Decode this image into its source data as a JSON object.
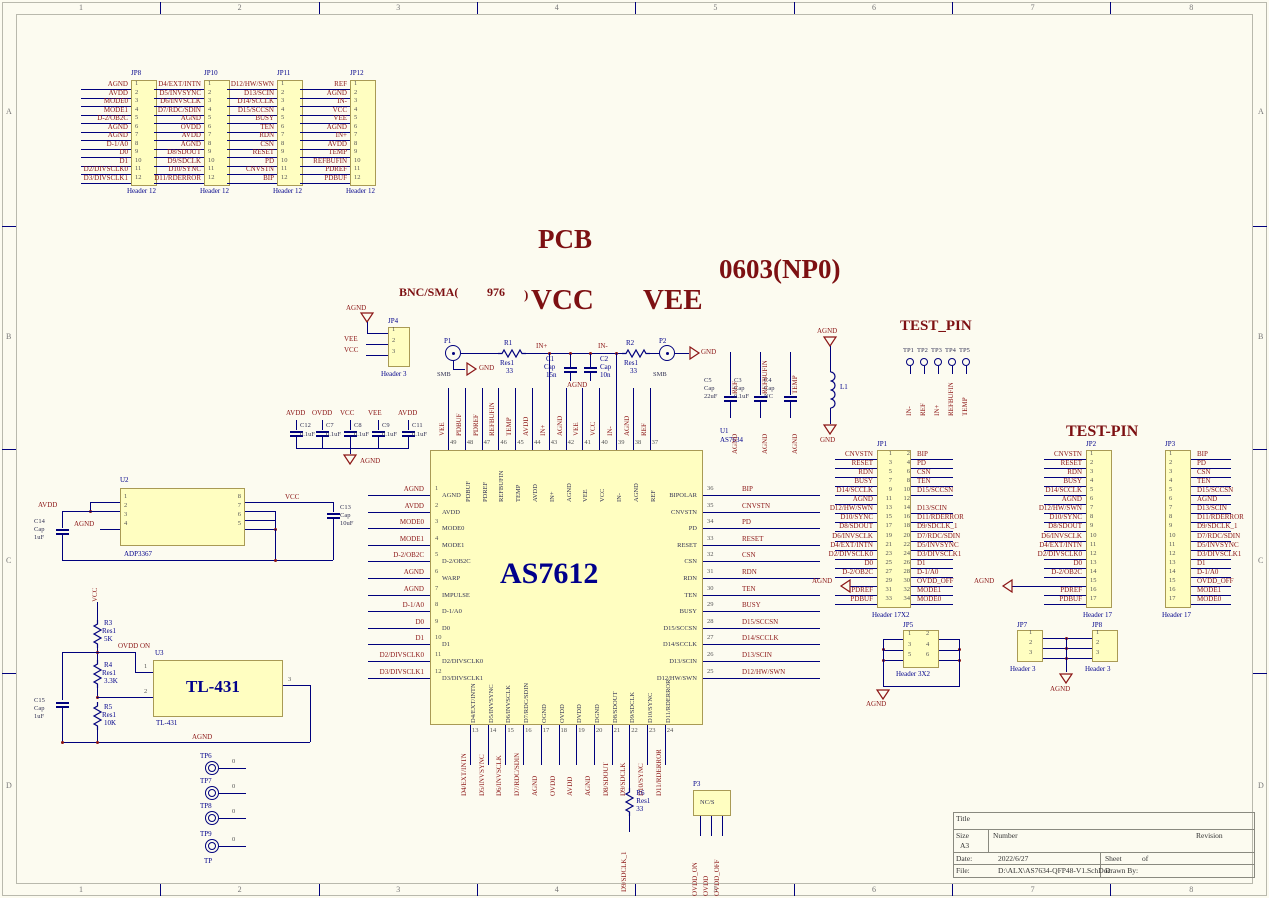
{
  "sheet": {
    "zones_h": [
      "1",
      "2",
      "3",
      "4",
      "5",
      "6",
      "7",
      "8"
    ],
    "zones_v": [
      "A",
      "B",
      "C",
      "D"
    ]
  },
  "colors": {
    "wire": "#00007d",
    "net_label": "#8b1515",
    "designator": "#00008b",
    "component_fill": "#fffec1",
    "title_red": "#7d1012"
  },
  "texts": {
    "pcb": "PCB",
    "bnc_sma": "BNC/SMA(",
    "bnc_num": "976",
    "paren": ")",
    "vcc": "VCC",
    "vee": "VEE",
    "cap_note": "0603(NP0)",
    "test_pin": "TEST_PIN",
    "test_pin2": "TEST-PIN"
  },
  "top_headers": [
    {
      "name": "JP8",
      "type": "Header 12",
      "labels": [
        "AGND",
        "AVDD",
        "MODE0",
        "MODE1",
        "D-2/OB2C",
        "AGND",
        "AGND",
        "D-1/A0",
        "D0",
        "D1",
        "D2/DIVSCLK0",
        "D3/DIVSCLK1"
      ]
    },
    {
      "name": "JP10",
      "type": "Header 12",
      "labels": [
        "D4/EXT/INTN",
        "D5/INVSYNC",
        "D6/INVSCLK",
        "D7/RDC/SDIN",
        "AGND",
        "OVDD",
        "AVDD",
        "AGND",
        "D8/SDOUT",
        "D9/SDCLK",
        "D10/SYNC",
        "D11/RDERROR"
      ]
    },
    {
      "name": "JP11",
      "type": "Header 12",
      "labels": [
        "D12/HW/SWN",
        "D13/SCIN",
        "D14/SCCLK",
        "D15/SCCSN",
        "BUSY",
        "TEN",
        "RDN",
        "CSN",
        "RESET",
        "PD",
        "CNVSTN",
        "BIP"
      ]
    },
    {
      "name": "JP12",
      "type": "Header 12",
      "labels": [
        "REF",
        "AGND",
        "IN-",
        "VCC",
        "VEE",
        "AGND",
        "IN+",
        "AVDD",
        "TEMP",
        "REFBUFIN",
        "PDREF",
        "PDBUF"
      ]
    }
  ],
  "jp4": {
    "name": "JP4",
    "type": "Header 3",
    "agnd": "AGND",
    "labels": [
      "VEE",
      "VCC"
    ]
  },
  "front_end": {
    "p1": "P1",
    "p2": "P2",
    "smb": "SMB",
    "gnd": "GND",
    "agnd": "AGND",
    "in_p": "IN+",
    "in_n": "IN-",
    "r1": {
      "d": "R1",
      "t": "Res1",
      "v": "33"
    },
    "r2": {
      "d": "R2",
      "t": "Res1",
      "v": "33"
    },
    "c1": {
      "d": "C1",
      "t": "Cap",
      "v": "15n"
    },
    "c2": {
      "d": "C2",
      "t": "Cap",
      "v": "10n"
    }
  },
  "decoupling": {
    "nets": [
      "AVDD",
      "OVDD",
      "VCC",
      "VEE",
      "AVDD"
    ],
    "designators": [
      "C12",
      "C7",
      "C8",
      "C9",
      "C11"
    ],
    "values": [
      "0.1uF",
      "0.1uF",
      "0.1uF",
      "0.1uF",
      "0.1uF"
    ],
    "agnd": "AGND"
  },
  "chip": {
    "designator": "U1",
    "type": "AS7634",
    "big_label": "AS7612",
    "left": [
      {
        "n": 1,
        "outer": "AGND",
        "inner": "AGND"
      },
      {
        "n": 2,
        "outer": "AVDD",
        "inner": "AVDD"
      },
      {
        "n": 3,
        "outer": "MODE0",
        "inner": "MODE0"
      },
      {
        "n": 4,
        "outer": "MODE1",
        "inner": "MODE1"
      },
      {
        "n": 5,
        "outer": "D-2/OB2C",
        "inner": "D-2/OB2C"
      },
      {
        "n": 6,
        "outer": "AGND",
        "inner": "WARP"
      },
      {
        "n": 7,
        "outer": "AGND",
        "inner": "IMPULSE"
      },
      {
        "n": 8,
        "outer": "D-1/A0",
        "inner": "D-1/A0"
      },
      {
        "n": 9,
        "outer": "D0",
        "inner": "D0"
      },
      {
        "n": 10,
        "outer": "D1",
        "inner": "D1"
      },
      {
        "n": 11,
        "outer": "D2/DIVSCLK0",
        "inner": "D2/DIVSCLK0"
      },
      {
        "n": 12,
        "outer": "D3/DIVSCLK1",
        "inner": "D3/DIVSCLK1"
      }
    ],
    "right": [
      {
        "n": 36,
        "outer": "BIP",
        "inner": "BIPOLAR"
      },
      {
        "n": 35,
        "outer": "CNVSTN",
        "inner": "CNVSTN"
      },
      {
        "n": 34,
        "outer": "PD",
        "inner": "PD"
      },
      {
        "n": 33,
        "outer": "RESET",
        "inner": "RESET"
      },
      {
        "n": 32,
        "outer": "CSN",
        "inner": "CSN"
      },
      {
        "n": 31,
        "outer": "RDN",
        "inner": "RDN"
      },
      {
        "n": 30,
        "outer": "TEN",
        "inner": "TEN"
      },
      {
        "n": 29,
        "outer": "BUSY",
        "inner": "BUSY"
      },
      {
        "n": 28,
        "outer": "D15/SCCSN",
        "inner": "D15/SCCSN"
      },
      {
        "n": 27,
        "outer": "D14/SCCLK",
        "inner": "D14/SCCLK"
      },
      {
        "n": 26,
        "outer": "D13/SCIN",
        "inner": "D13/SCIN"
      },
      {
        "n": 25,
        "outer": "D12/HW/SWN",
        "inner": "D12/HW/SWN"
      }
    ],
    "top": [
      {
        "n": 49,
        "outer": "VEE",
        "inner": ""
      },
      {
        "n": 48,
        "outer": "PDBUF",
        "inner": "PDBUF"
      },
      {
        "n": 47,
        "outer": "PDREF",
        "inner": "PDREF"
      },
      {
        "n": 46,
        "outer": "REFBUFIN",
        "inner": "REFBUFIN"
      },
      {
        "n": 45,
        "outer": "TEMP",
        "inner": "TEMP"
      },
      {
        "n": 44,
        "outer": "AVDD",
        "inner": "AVDD"
      },
      {
        "n": 43,
        "outer": "IN+",
        "inner": "IN+"
      },
      {
        "n": 42,
        "outer": "AGND",
        "inner": "AGND"
      },
      {
        "n": 41,
        "outer": "VEE",
        "inner": "VEE"
      },
      {
        "n": 40,
        "outer": "VCC",
        "inner": "VCC"
      },
      {
        "n": 39,
        "outer": "IN-",
        "inner": "IN-"
      },
      {
        "n": 38,
        "outer": "AGND",
        "inner": "AGND"
      },
      {
        "n": 37,
        "outer": "REF",
        "inner": "REF"
      }
    ],
    "bottom": [
      {
        "n": 13,
        "outer": "D4/EXT/INTN",
        "inner": "D4/EXT/INTN"
      },
      {
        "n": 14,
        "outer": "D5/INVSYNC",
        "inner": "D5/INVSYNC"
      },
      {
        "n": 15,
        "outer": "D6/INVSCLK",
        "inner": "D6/INVSCLK"
      },
      {
        "n": 16,
        "outer": "D7/RDC/SDIN",
        "inner": "D7/RDC/SDIN"
      },
      {
        "n": 17,
        "outer": "AGND",
        "inner": "OGND"
      },
      {
        "n": 18,
        "outer": "OVDD",
        "inner": "OVDD"
      },
      {
        "n": 19,
        "outer": "AVDD",
        "inner": "DVDD"
      },
      {
        "n": 20,
        "outer": "AGND",
        "inner": "DGND"
      },
      {
        "n": 21,
        "outer": "D8/SDOUT",
        "inner": "D8/SDOUT"
      },
      {
        "n": 22,
        "outer": "D9/SDCLK",
        "inner": "D9/SDCLK"
      },
      {
        "n": 23,
        "outer": "D10/SYNC",
        "inner": "D10/SYNC"
      },
      {
        "n": 24,
        "outer": "D11/RDERROR",
        "inner": "D11/RDERROR"
      }
    ]
  },
  "r6": {
    "d": "R6",
    "t": "Res1",
    "v": "33",
    "net": "D9/SDCLK_1"
  },
  "p3": {
    "name": "P3",
    "value": "NC/S",
    "nets": [
      "OVDD_ON",
      "OVDD",
      "OVDD_OFF"
    ]
  },
  "ref_caps": [
    {
      "d": "C5",
      "t": "Cap",
      "v": "22uF",
      "net": "REF",
      "gnd": "AGND"
    },
    {
      "d": "C3",
      "t": "Cap",
      "v": "0.1uF",
      "net": "REFBUFIN",
      "gnd": "AGND"
    },
    {
      "d": "C4",
      "t": "Cap",
      "v": "NC",
      "net": "TEMP",
      "gnd": "AGND"
    }
  ],
  "l1": {
    "d": "L1",
    "agnd": "AGND",
    "gnd": "GND"
  },
  "test_pin_top": {
    "tps": [
      "TP1",
      "TP2",
      "TP3",
      "TP4",
      "TP5"
    ],
    "nets": [
      "IN-",
      "REF",
      "IN+",
      "REFBUFIN",
      "TEMP"
    ]
  },
  "jp1": {
    "name": "JP1",
    "type": "Header 17X2",
    "agnd": "AGND",
    "left": [
      "CNVSTN",
      "RESET",
      "RDN",
      "BUSY",
      "D14/SCCLK",
      "AGND",
      "D12/HW/SWN",
      "D10/SYNC",
      "D8/SDOUT",
      "D6/INVSCLK",
      "D4/EXT/INTN",
      "D2/DIVSCLK0",
      "D0",
      "D-2/OB2C",
      "",
      "PDREF",
      "PDBUF"
    ],
    "right": [
      "BIP",
      "PD",
      "CSN",
      "TEN",
      "D15/SCCSN",
      "",
      "D13/SCIN",
      "D11/RDERROR",
      "D9/SDCLK_1",
      "D7/RDC/SDIN",
      "D5/INVSYNC",
      "D3/DIVSCLK1",
      "D1",
      "D-1/A0",
      "OVDD_OFF",
      "MODE1",
      "MODE0"
    ]
  },
  "jp2": {
    "name": "JP2",
    "type": "Header 17",
    "agnd": "AGND",
    "labels": [
      "CNVSTN",
      "RESET",
      "RDN",
      "BUSY",
      "D14/SCCLK",
      "AGND",
      "D12/HW/SWN",
      "D10/SYNC",
      "D8/SDOUT",
      "D6/INVSCLK",
      "D4/EXT/INTN",
      "D2/DIVSCLK0",
      "D0",
      "D-2/OB2C",
      "",
      "PDREF",
      "PDBUF"
    ]
  },
  "jp3": {
    "name": "JP3",
    "type": "Header 17",
    "labels": [
      "BIP",
      "PD",
      "CSN",
      "TEN",
      "D15/SCCSN",
      "AGND",
      "D13/SCIN",
      "D11/RDERROR",
      "D9/SDCLK_1",
      "D7/RDC/SDIN",
      "D5/INVSYNC",
      "D3/DIVSCLK1",
      "D1",
      "D-1/A0",
      "OVDD_OFF",
      "MODE1",
      "MODE0"
    ]
  },
  "jp5": {
    "name": "JP5",
    "type": "Header 3X2",
    "agnd": "AGND"
  },
  "jp7": {
    "name": "JP7",
    "type": "Header 3"
  },
  "jp8b": {
    "name": "JP8",
    "type": "Header 3",
    "agnd": "AGND"
  },
  "u2": {
    "designator": "U2",
    "type": "ADP3367",
    "avdd": "AVDD",
    "agnd": "AGND",
    "vcc": "VCC",
    "c13": {
      "d": "C13",
      "t": "Cap",
      "v": "10uF"
    },
    "c14": {
      "d": "C14",
      "t": "Cap",
      "v": "1uF"
    },
    "left_pins": [
      1,
      2,
      3,
      4
    ],
    "right_pins": [
      8,
      7,
      6,
      5
    ]
  },
  "u3": {
    "designator": "U3",
    "big_label": "TL-431",
    "type": "TL-431",
    "vcc": "VCC",
    "ovdd_on": "OVDD ON",
    "agnd": "AGND",
    "r3": {
      "d": "R3",
      "t": "Res1",
      "v": "5K"
    },
    "r4": {
      "d": "R4",
      "t": "Res1",
      "v": "3.3K"
    },
    "r5": {
      "d": "R5",
      "t": "Res1",
      "v": "10K"
    },
    "c15": {
      "d": "C15",
      "t": "Cap",
      "v": "1uF"
    },
    "pins": [
      1,
      2,
      3
    ]
  },
  "tp_bottom": {
    "tps": [
      "TP6",
      "TP7",
      "TP8",
      "TP9"
    ],
    "pin": "0",
    "type": "TP"
  },
  "titleblock": {
    "title_label": "Title",
    "size_label": "Size",
    "size": "A3",
    "number_label": "Number",
    "revision_label": "Revision",
    "date_label": "Date:",
    "date": "2022/6/27",
    "sheet_label": "Sheet",
    "of_label": "of",
    "file_label": "File:",
    "file": "D:\\ALX\\AS7634-QFP48-V1.SchDoc",
    "drawn_label": "Drawn By:"
  }
}
